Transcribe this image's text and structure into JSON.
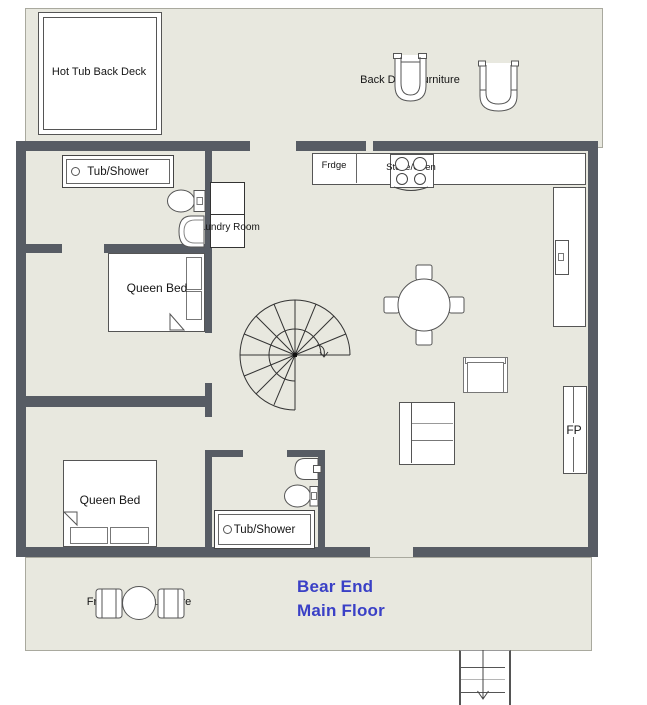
{
  "title": {
    "line1": "Bear End",
    "line2": "Main Floor"
  },
  "labels": {
    "hot_tub": "Hot Tub Back Deck",
    "back_deck_furniture": "Back Deck Furniture",
    "front_porch_furniture": "Front Porch Furniture",
    "tub_shower_upper": "Tub/Shower",
    "tub_shower_lower": "Tub/Shower",
    "laundry_room": "Laundry Room",
    "queen_bed_upper": "Queen Bed",
    "queen_bed_lower": "Queen Bed",
    "fridge": "Frdge",
    "stove_oven": "Stove/Oven",
    "dining_table": "Dining Table",
    "fireplace": "FP"
  },
  "colors": {
    "wall": "#575c64",
    "floor": "#e8e8df",
    "accent_title": "#3a40c6",
    "outline": "#555555"
  }
}
